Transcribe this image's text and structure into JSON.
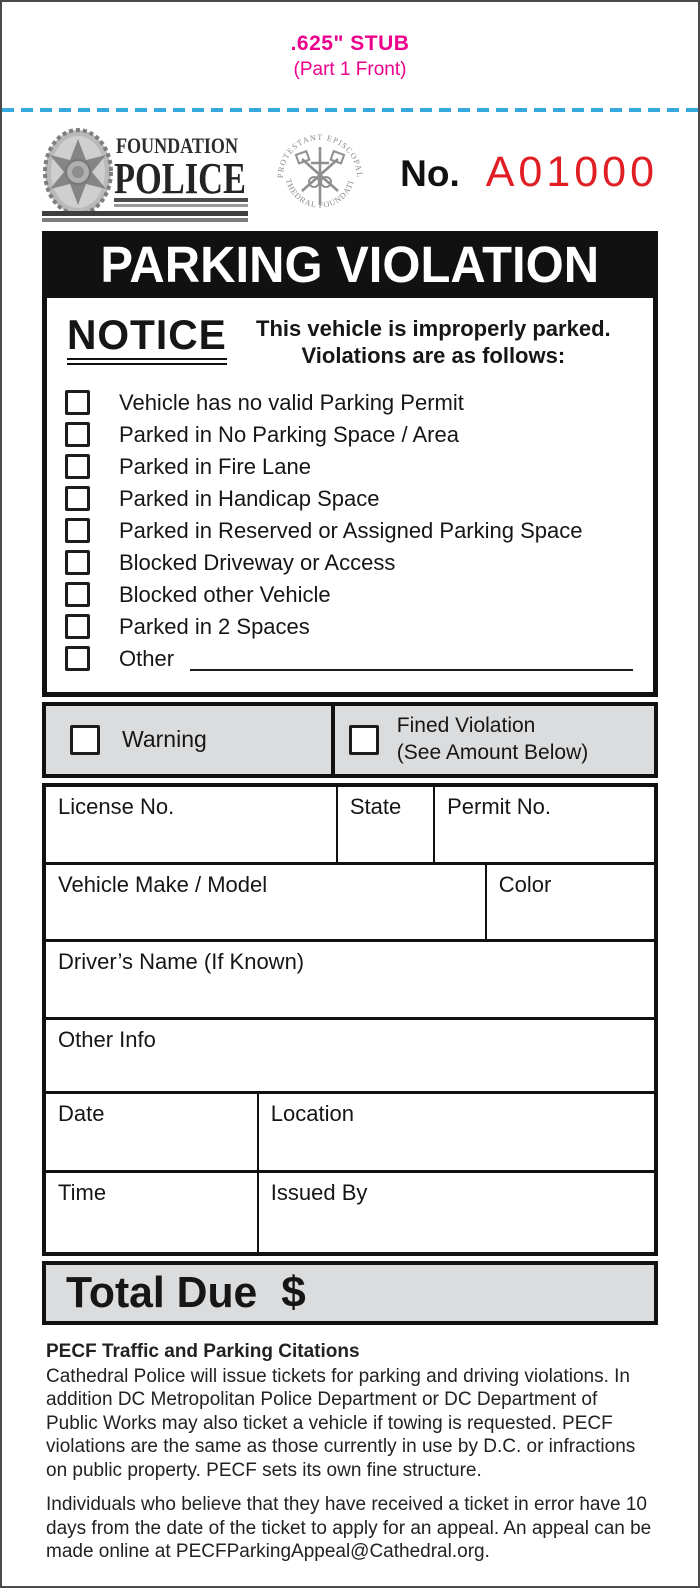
{
  "page": {
    "stub_line1": ".625\" STUB",
    "stub_line2": "(Part 1 Front)"
  },
  "header": {
    "agency_top": "FOUNDATION",
    "agency_main": "POLICE",
    "seal_top": "PROTESTANT EPISCOPAL",
    "seal_bottom": "CATHEDRAL FOUNDATION",
    "number_label": "No.",
    "number_value": "A01000"
  },
  "banner": {
    "title": "PARKING VIOLATION"
  },
  "notice": {
    "heading": "NOTICE",
    "intro_line1": "This vehicle is improperly parked.",
    "intro_line2": "Violations are as follows:",
    "items": [
      "Vehicle has no valid Parking Permit",
      "Parked in No Parking Space / Area",
      "Parked in Fire Lane",
      "Parked in Handicap Space",
      "Parked in Reserved or Assigned Parking Space",
      "Blocked Driveway or Access",
      "Blocked other Vehicle",
      "Parked in 2 Spaces",
      "Other"
    ]
  },
  "disposition": {
    "warning_label": "Warning",
    "fined_line1": "Fined Violation",
    "fined_line2": "(See Amount Below)"
  },
  "fields": {
    "license": "License No.",
    "state": "State",
    "permit": "Permit No.",
    "make_model": "Vehicle Make / Model",
    "color": "Color",
    "driver": "Driver’s Name (If Known)",
    "other_info": "Other Info",
    "date": "Date",
    "location": "Location",
    "time": "Time",
    "issued_by": "Issued By"
  },
  "total": {
    "label": "Total Due",
    "currency": "$"
  },
  "footer": {
    "heading": "PECF Traffic and Parking Citations",
    "para1": "Cathedral Police will issue tickets for parking and driving violations. In addition DC Metropolitan Police Department or DC Department of Public Works may also ticket a vehicle if towing is requested. PECF violations are the same as those currently in use by D.C. or infractions on public property. PECF sets its own fine structure.",
    "para2": "Individuals who believe that they have received a ticket in error have 10 days from the date of the ticket to apply for an appeal. An appeal can be made online at PECFParkingAppeal@Cathedral.org."
  },
  "colors": {
    "stub_magenta": "#EC008C",
    "perforation_cyan": "#35A8DC",
    "ticket_number_red": "#E01E24",
    "panel_gray": "#DBDCDD",
    "ink_black": "#111111"
  }
}
